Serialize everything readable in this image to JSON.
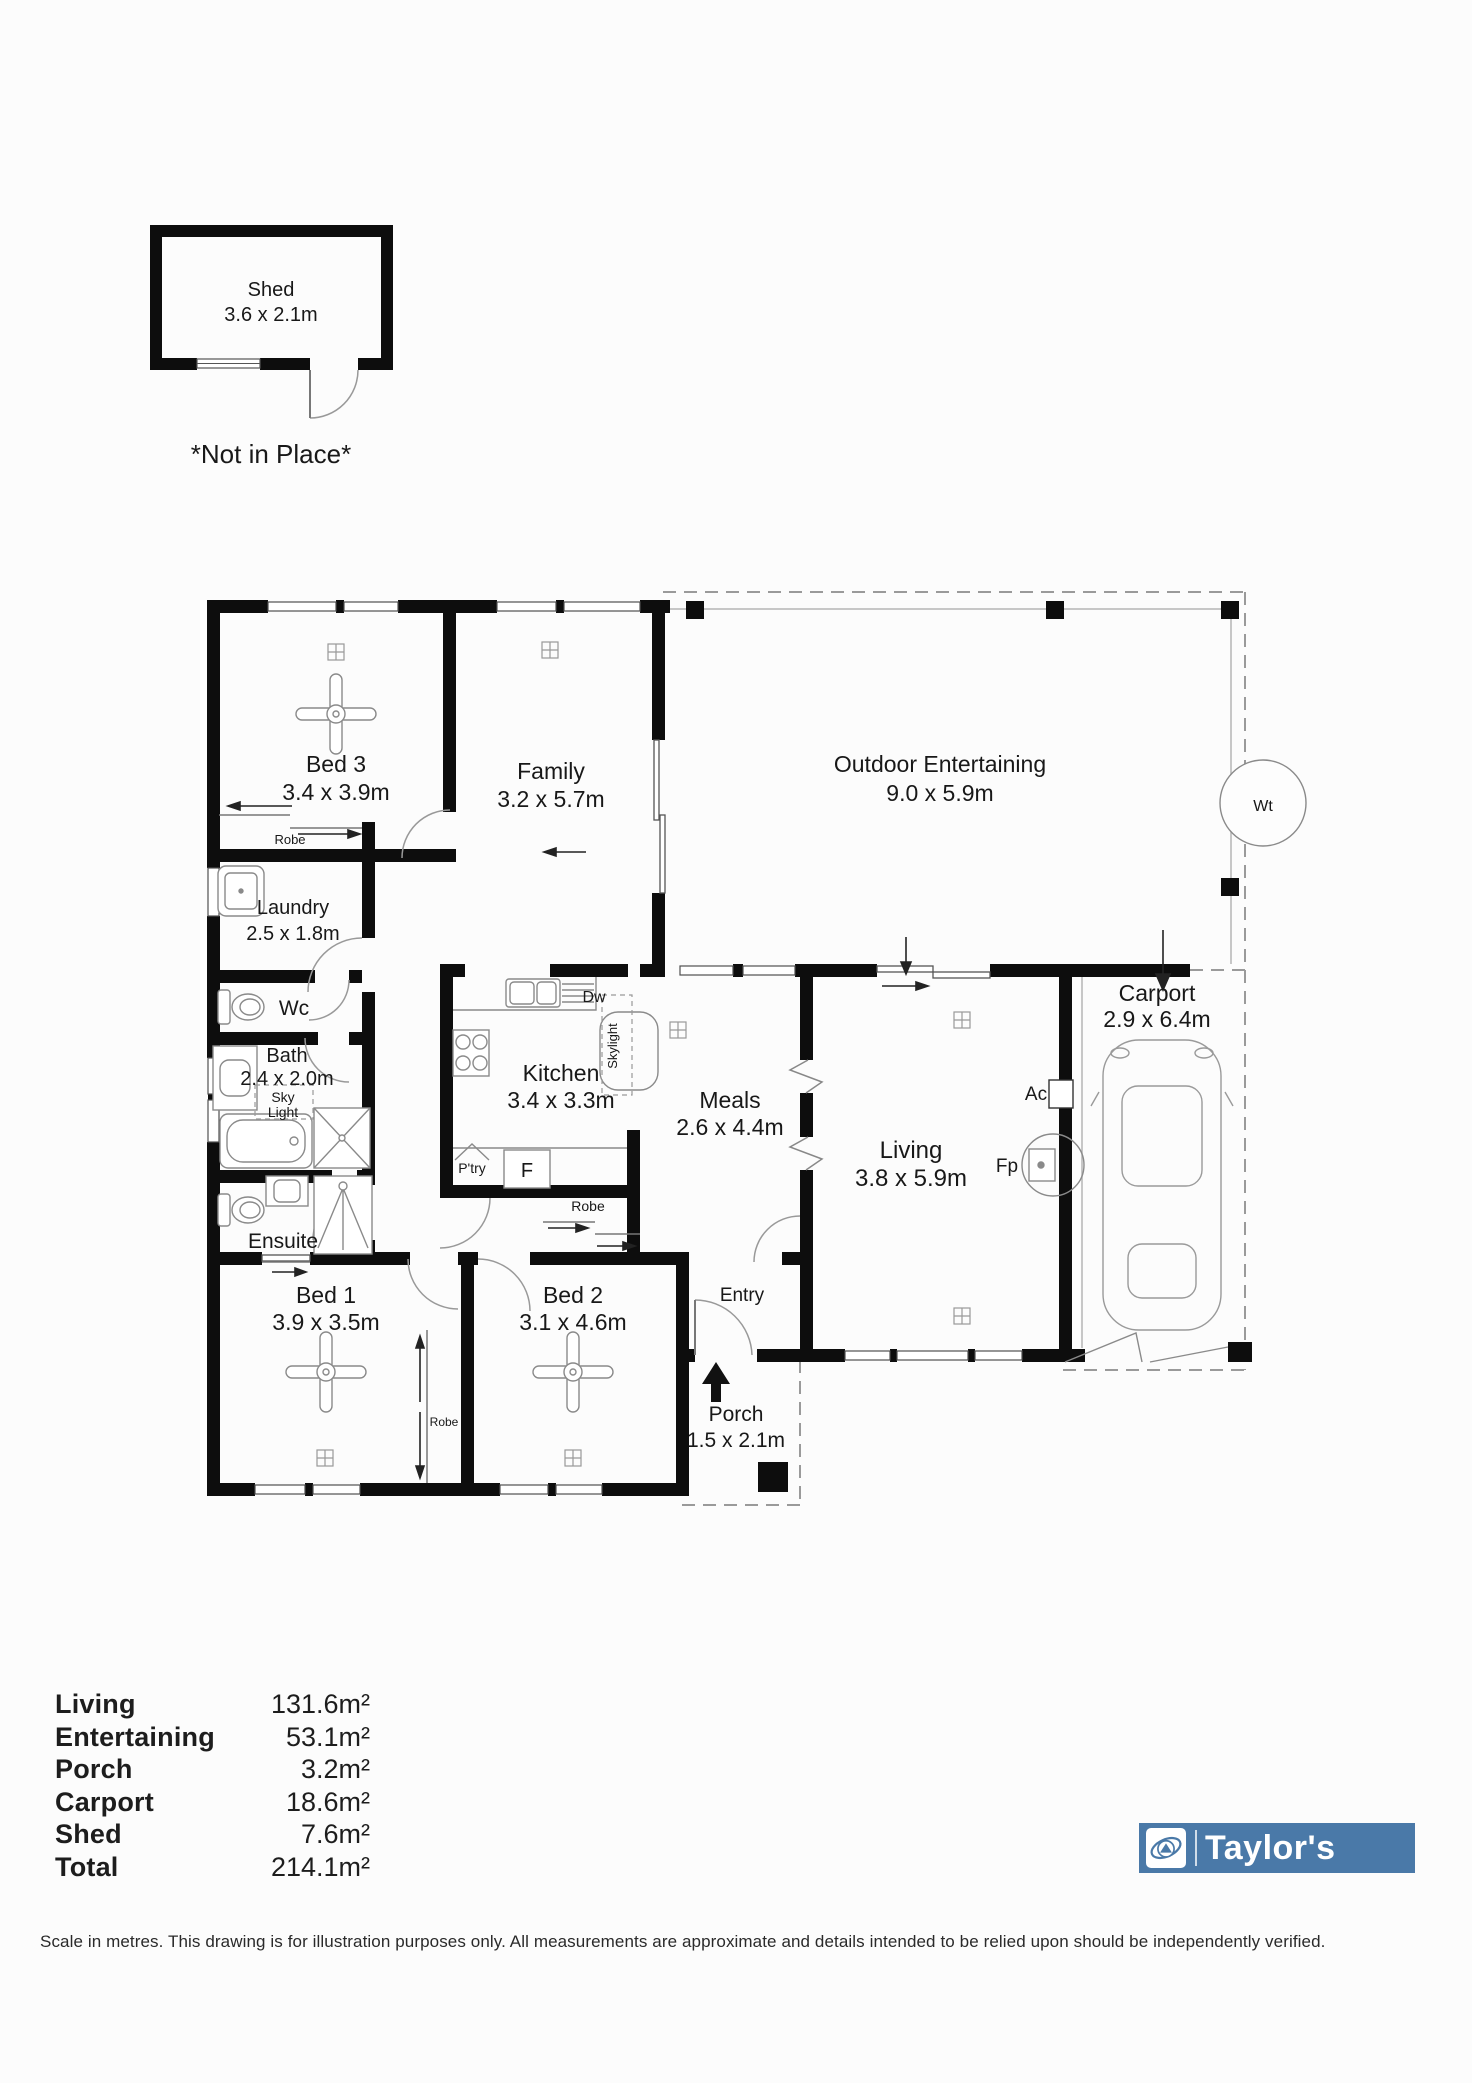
{
  "shed": {
    "name": "Shed",
    "dims": "3.6 x 2.1m",
    "note": "*Not in Place*"
  },
  "rooms": {
    "bed3": {
      "name": "Bed 3",
      "dims": "3.4 x 3.9m"
    },
    "family": {
      "name": "Family",
      "dims": "3.2 x 5.7m"
    },
    "outdoor": {
      "name": "Outdoor Entertaining",
      "dims": "9.0 x 5.9m"
    },
    "laundry": {
      "name": "Laundry",
      "dims": "2.5 x 1.8m"
    },
    "wc": {
      "name": "Wc"
    },
    "bath": {
      "name": "Bath",
      "dims": "2.4 x 2.0m"
    },
    "ensuite": {
      "name": "Ensuite"
    },
    "kitchen": {
      "name": "Kitchen",
      "dims": "3.4 x 3.3m"
    },
    "meals": {
      "name": "Meals",
      "dims": "2.6 x 4.4m"
    },
    "living": {
      "name": "Living",
      "dims": "3.8 x 5.9m"
    },
    "carport": {
      "name": "Carport",
      "dims": "2.9 x 6.4m"
    },
    "bed1": {
      "name": "Bed 1",
      "dims": "3.9 x 3.5m"
    },
    "bed2": {
      "name": "Bed 2",
      "dims": "3.1 x 4.6m"
    },
    "entry": {
      "name": "Entry"
    },
    "porch": {
      "name": "Porch",
      "dims": "1.5 x 2.1m"
    }
  },
  "annotations": {
    "robe_bed3": "Robe",
    "robe_kitchen": "Robe",
    "robe_beds": "Robe",
    "dishwasher": "Dw",
    "skylight_kitchen": "Skylight",
    "skylight_bath_line1": "Sky",
    "skylight_bath_line2": "Light",
    "pantry": "P'try",
    "fridge": "F",
    "air_conditioner": "Ac",
    "fireplace": "Fp",
    "water_tank": "Wt"
  },
  "summary": {
    "rows": [
      {
        "label": "Living",
        "value": "131.6m²"
      },
      {
        "label": "Entertaining",
        "value": "53.1m²"
      },
      {
        "label": "Porch",
        "value": "3.2m²"
      },
      {
        "label": "Carport",
        "value": "18.6m²"
      },
      {
        "label": "Shed",
        "value": "7.6m²"
      },
      {
        "label": "Total",
        "value": "214.1m²"
      }
    ]
  },
  "logo": {
    "text": "Taylor's"
  },
  "disclaimer": "Scale in metres. This drawing is for illustration purposes only. All measurements are approximate and details intended to be relied upon should be independently verified.",
  "colors": {
    "brand_blue": "#4a79a8",
    "wall": "#0d0d0d"
  }
}
